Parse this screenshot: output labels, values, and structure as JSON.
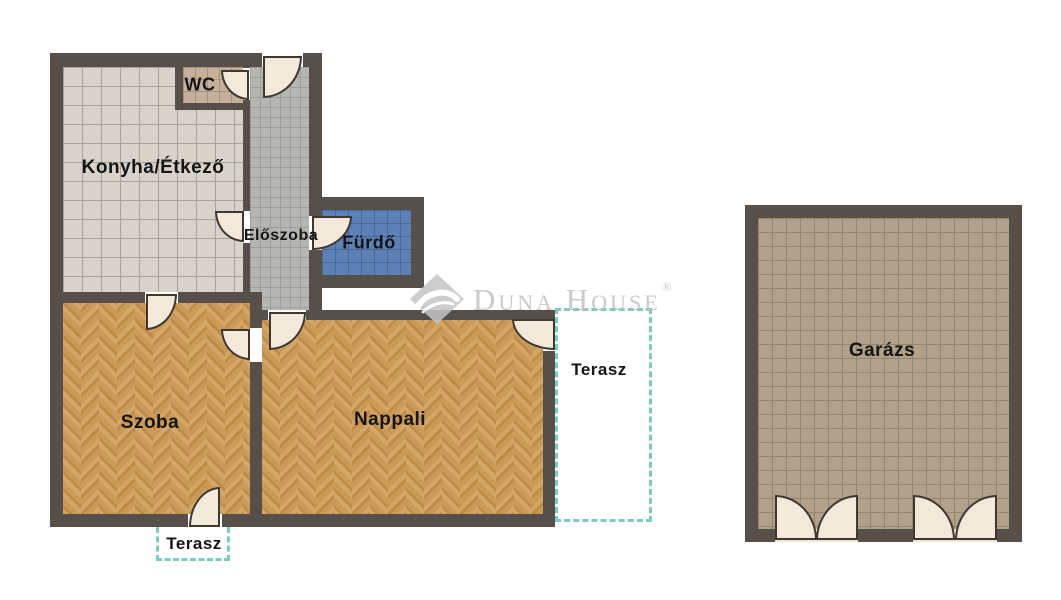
{
  "watermark": {
    "brand": "Duna House",
    "registered": "®"
  },
  "rooms": {
    "kitchen": "Konyha/Étkező",
    "wc": "WC",
    "hall": "Előszoba",
    "bath": "Fürdő",
    "room": "Szoba",
    "living": "Nappali",
    "terrace_right": "Terasz",
    "terrace_bottom": "Terasz",
    "garage": "Garázs"
  },
  "colors": {
    "wall": "#57504a",
    "wood_floor": "#c99755",
    "kitchen_tile": "#d9d2ca",
    "wc_tile": "#c5b09c",
    "hall_tile": "#b5b5b2",
    "bath_tile": "#5d81b6",
    "garage_tile": "#b1a18a",
    "terrace_dash": "#7ccac3",
    "door": "#f2e9da",
    "label_text": "#151515",
    "watermark_gray": "#c2c1c1"
  }
}
